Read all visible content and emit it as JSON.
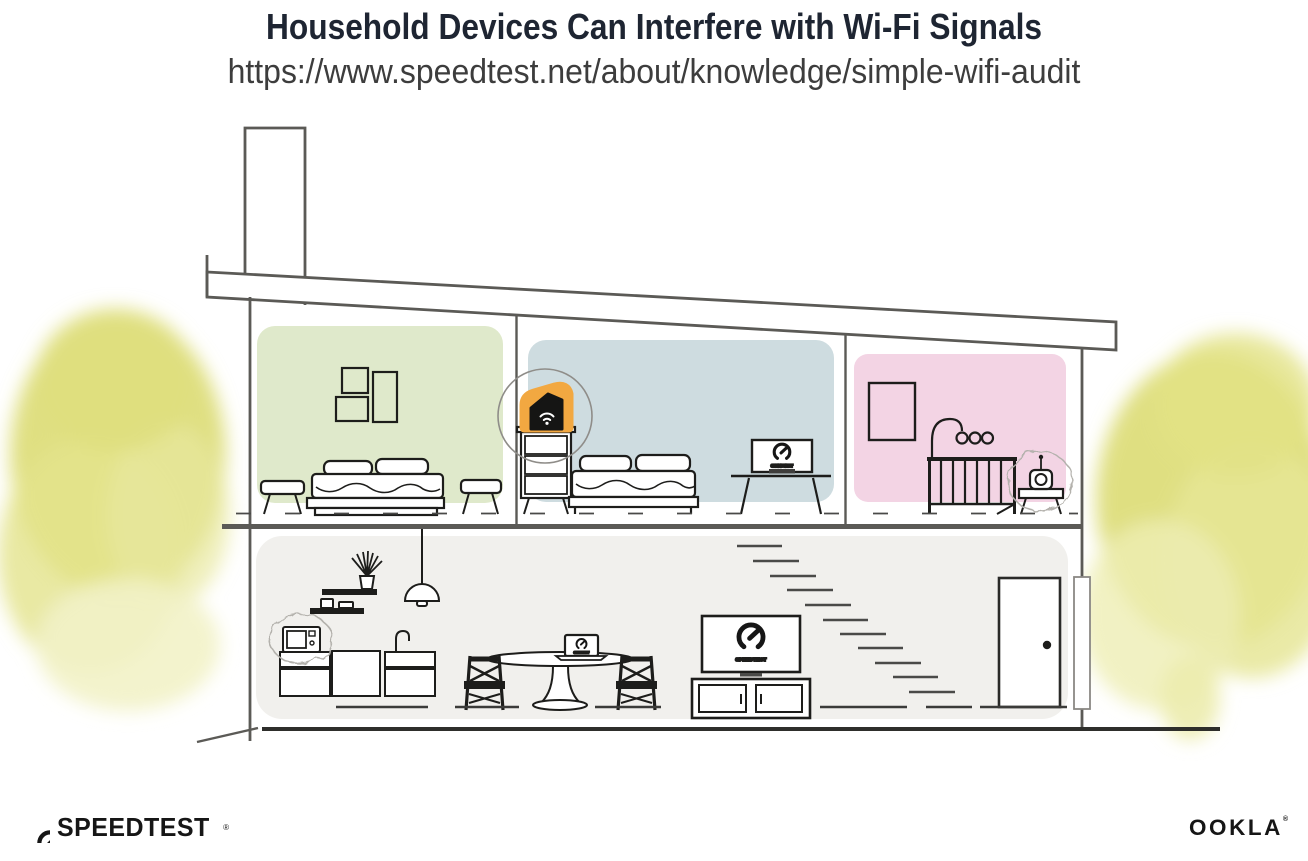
{
  "header": {
    "title": "Household Devices Can Interfere with Wi-Fi Signals",
    "url": "https://www.speedtest.net/about/knowledge/simple-wifi-audit"
  },
  "branding": {
    "speedtest": "SPEEDTEST",
    "speedtest_mark": "®",
    "ookla": "OOKLA",
    "ookla_mark": "®"
  },
  "screens": {
    "bedroom_monitor_label": "SPEEDTEST",
    "living_tv_label": "SPEEDTEST",
    "dining_laptop_label": "SPEEDTEST"
  },
  "illustration_notes": {
    "highlighted_device": "wifi-router",
    "interference_sources": [
      "microwave",
      "baby-monitor"
    ]
  },
  "palette": {
    "title_color": "#1e2532",
    "subtitle_color": "#3d3d3d",
    "structure_line": "#5b5a56",
    "furniture_line": "#1d1d1b",
    "bedroom_green": "#dfe9cb",
    "bedroom_blue": "#cedce0",
    "nursery_pink": "#f3d4e4",
    "living_gray": "#f1f0ed",
    "router_orange": "#f2a841",
    "foliage_yellow": "#dcdc74",
    "foliage_light": "#f2f2c8"
  }
}
